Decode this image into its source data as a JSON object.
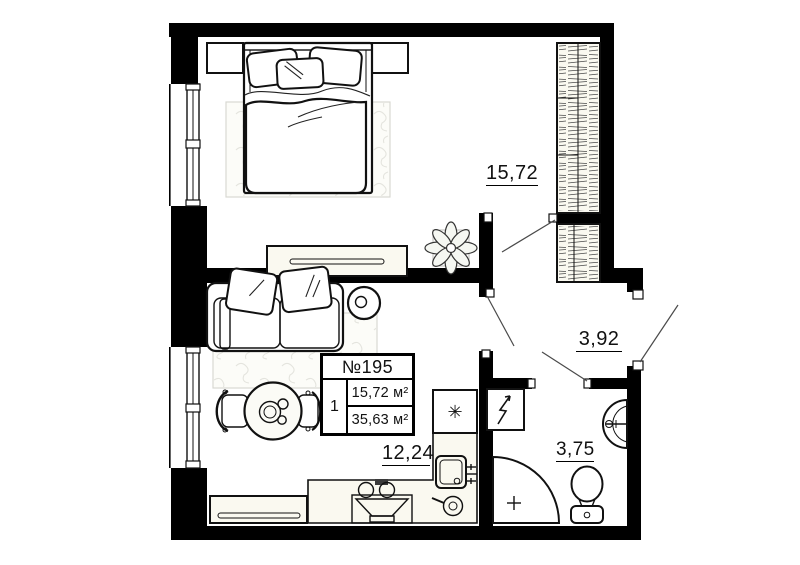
{
  "unit_card": {
    "unit_number": "№195",
    "rooms_count": "1",
    "living_area": "15,72 м²",
    "total_area": "35,63 м²"
  },
  "area_labels": {
    "bedroom": "15,72",
    "hallway": "3,92",
    "kitchen_living": "12,24",
    "bathroom": "3,75"
  },
  "icons": {
    "fridge_snowflake": "✳",
    "water_heater": "lightning-bolt-icon",
    "shower_head": "plus-icon"
  },
  "colors": {
    "wall": "#000000",
    "background": "#ffffff",
    "furniture_cream": "#faf9f0",
    "rug_line": "#e4e4de"
  }
}
